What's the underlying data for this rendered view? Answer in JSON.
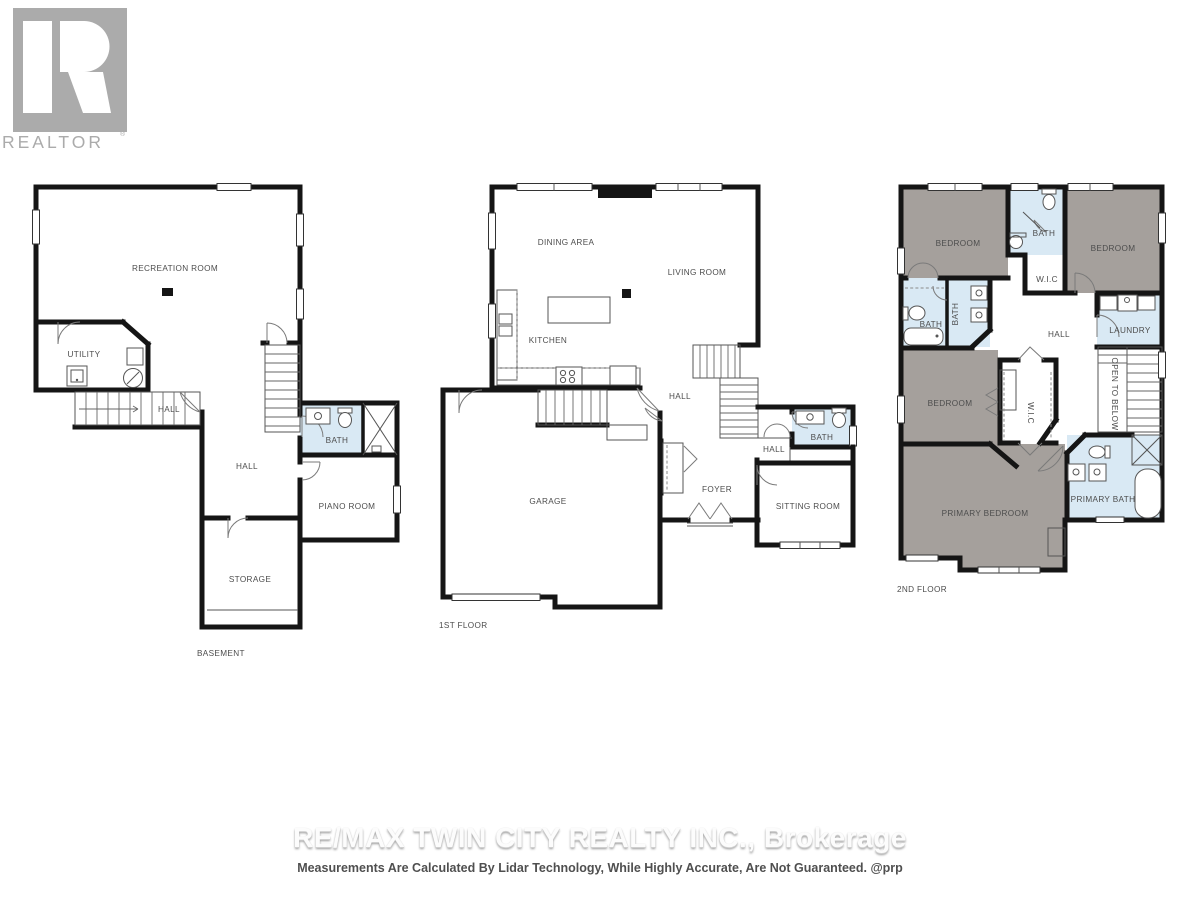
{
  "logo": {
    "brand": "REALTOR",
    "registered": "®"
  },
  "floors": {
    "basement": {
      "name": "BASEMENT",
      "rooms": {
        "recreation": "RECREATION ROOM",
        "utility": "UTILITY",
        "hall_stairs": "HALL",
        "hall": "HALL",
        "bath": "BATH",
        "piano": "PIANO ROOM",
        "storage": "STORAGE"
      }
    },
    "first": {
      "name": "1ST FLOOR",
      "rooms": {
        "dining": "DINING AREA",
        "living": "LIVING ROOM",
        "kitchen": "KITCHEN",
        "hall_upper": "HALL",
        "garage": "GARAGE",
        "foyer": "FOYER",
        "hall_lower": "HALL",
        "bath": "BATH",
        "sitting": "SITTING ROOM"
      }
    },
    "second": {
      "name": "2ND FLOOR",
      "rooms": {
        "bedroom_tl": "BEDROOM",
        "bath_top": "BATH",
        "bedroom_tr": "BEDROOM",
        "wic_top": "W.I.C",
        "bath_left_v": "BATH",
        "bath_left_h": "BATH",
        "hall": "HALL",
        "laundry": "LAUNDRY",
        "bedroom_mid": "BEDROOM",
        "wic_mid": "W.I.C",
        "open_below": "OPEN TO BELOW",
        "primary_bedroom": "PRIMARY BEDROOM",
        "primary_bath": "PRIMARY BATH"
      }
    }
  },
  "footer": {
    "brokerage": "RE/MAX TWIN CITY REALTY INC., Brokerage",
    "disclaimer": "Measurements Are Calculated By Lidar Technology, While Highly Accurate, Are Not Guaranteed. @prp"
  },
  "colors": {
    "wall": "#151515",
    "bedroom_fill": "#a5a09c",
    "bath_fill": "#d9e9f4",
    "label_text": "#4d4d4d",
    "logo_gray": "#ababab",
    "watermark": "#fcfcfc"
  }
}
